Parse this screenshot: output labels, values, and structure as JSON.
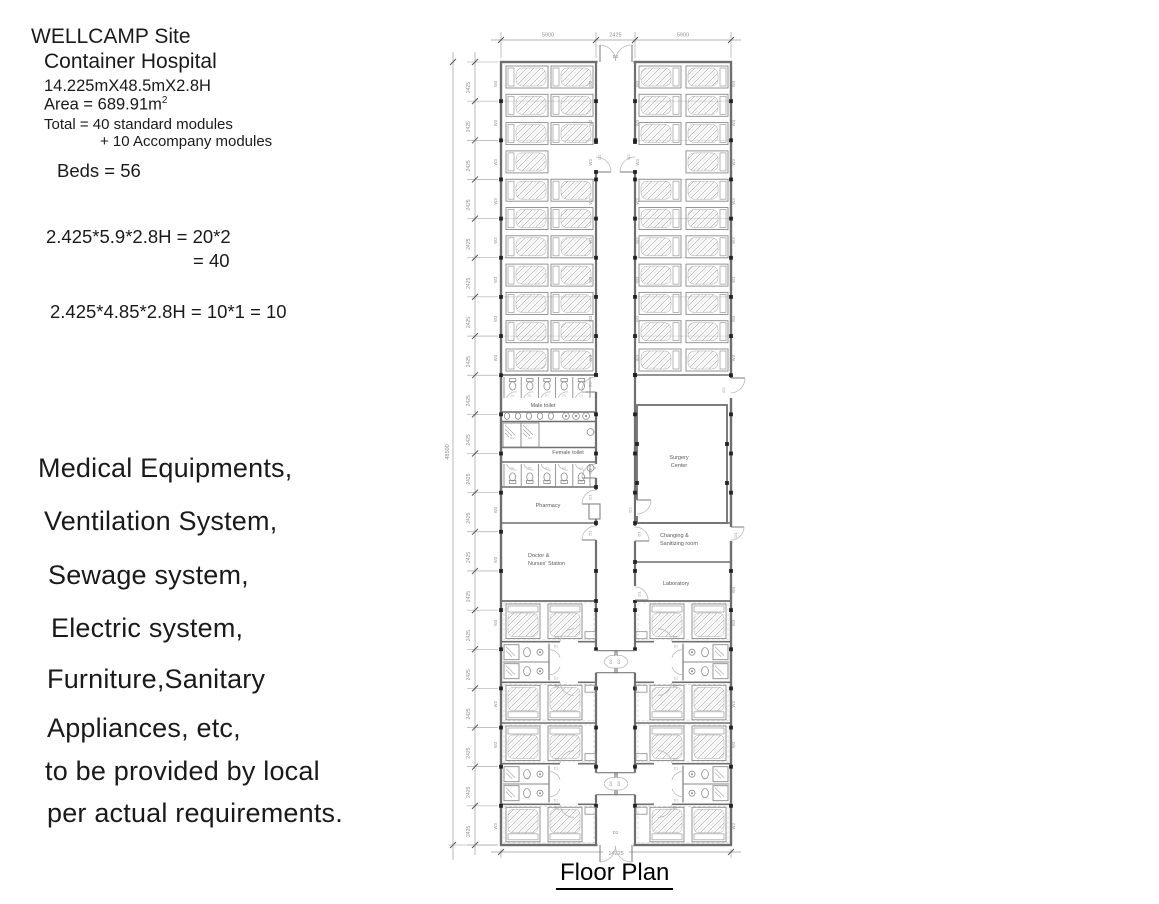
{
  "notes": {
    "title_line1": "WELLCAMP Site",
    "title_line2": "Container Hospital",
    "size_line": "14.225mX48.5mX2.8H",
    "area_line": "Area = 689.91m",
    "area_sup": "2",
    "total_line1": "Total = 40 standard modules",
    "total_line2": "+ 10 Accompany modules",
    "beds_line": "Beds = 56",
    "formula1_line1": "2.425*5.9*2.8H = 20*2",
    "formula1_line2": "= 40",
    "formula2": "2.425*4.85*2.8H = 10*1 = 10",
    "provisions": [
      "Medical Equipments,",
      "Ventilation System,",
      "Sewage system,",
      "Electric system,",
      "Furniture,Sanitary",
      "Appliances, etc,",
      "to be provided by local",
      "per actual requirements."
    ]
  },
  "plan": {
    "caption": "Floor Plan",
    "dims": {
      "top": [
        "5900",
        "2425",
        "5900"
      ],
      "module": "2425",
      "total": "48500",
      "bottom": "14225"
    },
    "tags": {
      "d1": "D1",
      "d2": "D2",
      "window": "W3"
    },
    "rooms": {
      "male_toilet": "Male toilet",
      "female_toilet": "Female toilet",
      "pharmacy": "Pharmacy",
      "doctor_line1": "Doctor &",
      "doctor_line2": "Nurses' Station",
      "surgery_line1": "Surgery",
      "surgery_line2": "Center",
      "changing_line1": "Changing &",
      "changing_line2": "Sanitizing room",
      "laboratory": "Laboratory"
    }
  }
}
